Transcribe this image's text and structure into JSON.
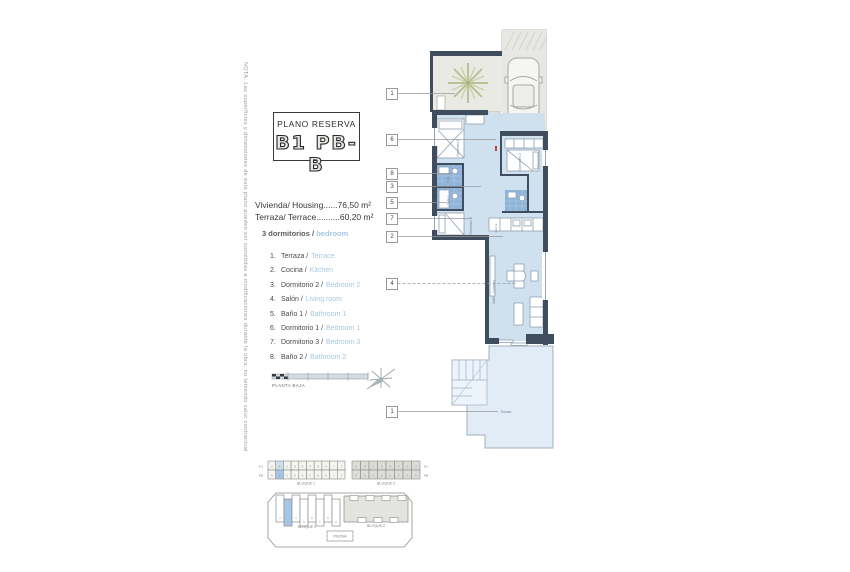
{
  "note": "NOTA: Las superficies y dimensiones de este plano pueden ser sometidas a modificaciones durante la obra, no teniendo valor contractual",
  "title_block": {
    "label": "PLANO RESERVA",
    "unit": "B1 PB-B"
  },
  "areas": [
    {
      "label": "Vivienda/ Housing",
      "dots": "......",
      "value": "76,50 m²"
    },
    {
      "label": "Terraza/ Terrace",
      "dots": "..........",
      "value": "60,20 m²"
    }
  ],
  "legend": {
    "heading_es": "3 dormitorios /",
    "heading_en": "bedroom",
    "items": [
      {
        "num": "1.",
        "es": "Terraza /",
        "en": "Terrace"
      },
      {
        "num": "2.",
        "es": "Cocina /",
        "en": "Kitchen"
      },
      {
        "num": "3.",
        "es": "Dormitorio 2 /",
        "en": "Bedroom 2"
      },
      {
        "num": "4.",
        "es": "Salón /",
        "en": "Living room"
      },
      {
        "num": "5.",
        "es": "Baño 1 /",
        "en": "Bathroom 1"
      },
      {
        "num": "6.",
        "es": "Dormitorio 1 /",
        "en": "Bedroom 1"
      },
      {
        "num": "7.",
        "es": "Dormitorio 3 /",
        "en": "Bedroom 3"
      },
      {
        "num": "8.",
        "es": "Baño 2 /",
        "en": "Bathroom 2"
      }
    ]
  },
  "scale_label": "PLANTA BAJA",
  "callouts": [
    "1",
    "6",
    "8",
    "3",
    "5",
    "7",
    "2",
    "4",
    "1"
  ],
  "plan_labels": {
    "dorm1": "Dormitorio 1",
    "dorm2": "Dormitorio 2",
    "dorm3": "Dormitorio 3",
    "bano1": "Baño 1",
    "bano2": "Baño 2",
    "cocina": "Cocina",
    "salon": "Salón - Comedor",
    "terraza": "Terraza"
  },
  "key": {
    "bloque1": "BLOQUE 1",
    "bloque2": "BLOQUE 2",
    "row_top": "P1",
    "row_bottom": "PB",
    "piscina": "PISCINA",
    "b1_cells": [
      "A",
      "B",
      "C",
      "D",
      "E",
      "F",
      "G",
      "H",
      "I",
      "J"
    ],
    "b2_cells": [
      "A",
      "B",
      "C",
      "D",
      "E",
      "F",
      "G",
      "H"
    ],
    "highlight_index": 1
  },
  "colors": {
    "accent_blue": "#a7c7df",
    "highlight_blue": "#a5c6e8",
    "room_fill": "#cfe0ef",
    "terrace_fill": "#e1ecf6",
    "tile_blue": "#8fb4d8",
    "wall": "#3f4d5f"
  }
}
